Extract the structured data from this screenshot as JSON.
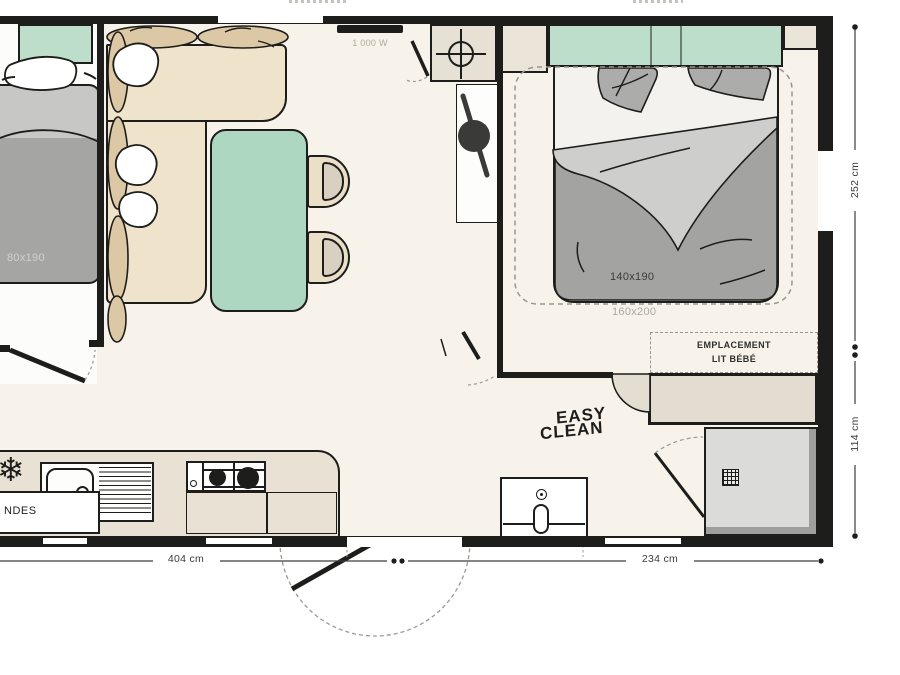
{
  "floorplan": {
    "labels": {
      "heater_power": "1 000 W",
      "small_bed_size": "80x190",
      "double_bed_size": "140x190",
      "double_bed_outline_size": "160x200",
      "baby_bed_line1": "EMPLACEMENT",
      "baby_bed_line2": "LIT BÉBÉ",
      "logo_line1": "EASY",
      "logo_line2": "CLEAN",
      "clipped_left_text": "NDES"
    },
    "dimensions": {
      "bottom_left": "404 cm",
      "bottom_right": "234 cm",
      "right_upper": "252 cm",
      "right_lower": "114 cm"
    },
    "icons": {
      "fridge_snowflake": "❄"
    },
    "colors": {
      "wall": "#1d1d1b",
      "floor": "#f7f3ea",
      "mint_green": "#b4dac4",
      "sofa_beige": "#efe4cb",
      "cushion_tan": "#dcc8a4",
      "bed_grey": "#a5a5a4",
      "counter_beige": "#e9e2d4",
      "shower_grey": "#dbdbd9"
    }
  }
}
